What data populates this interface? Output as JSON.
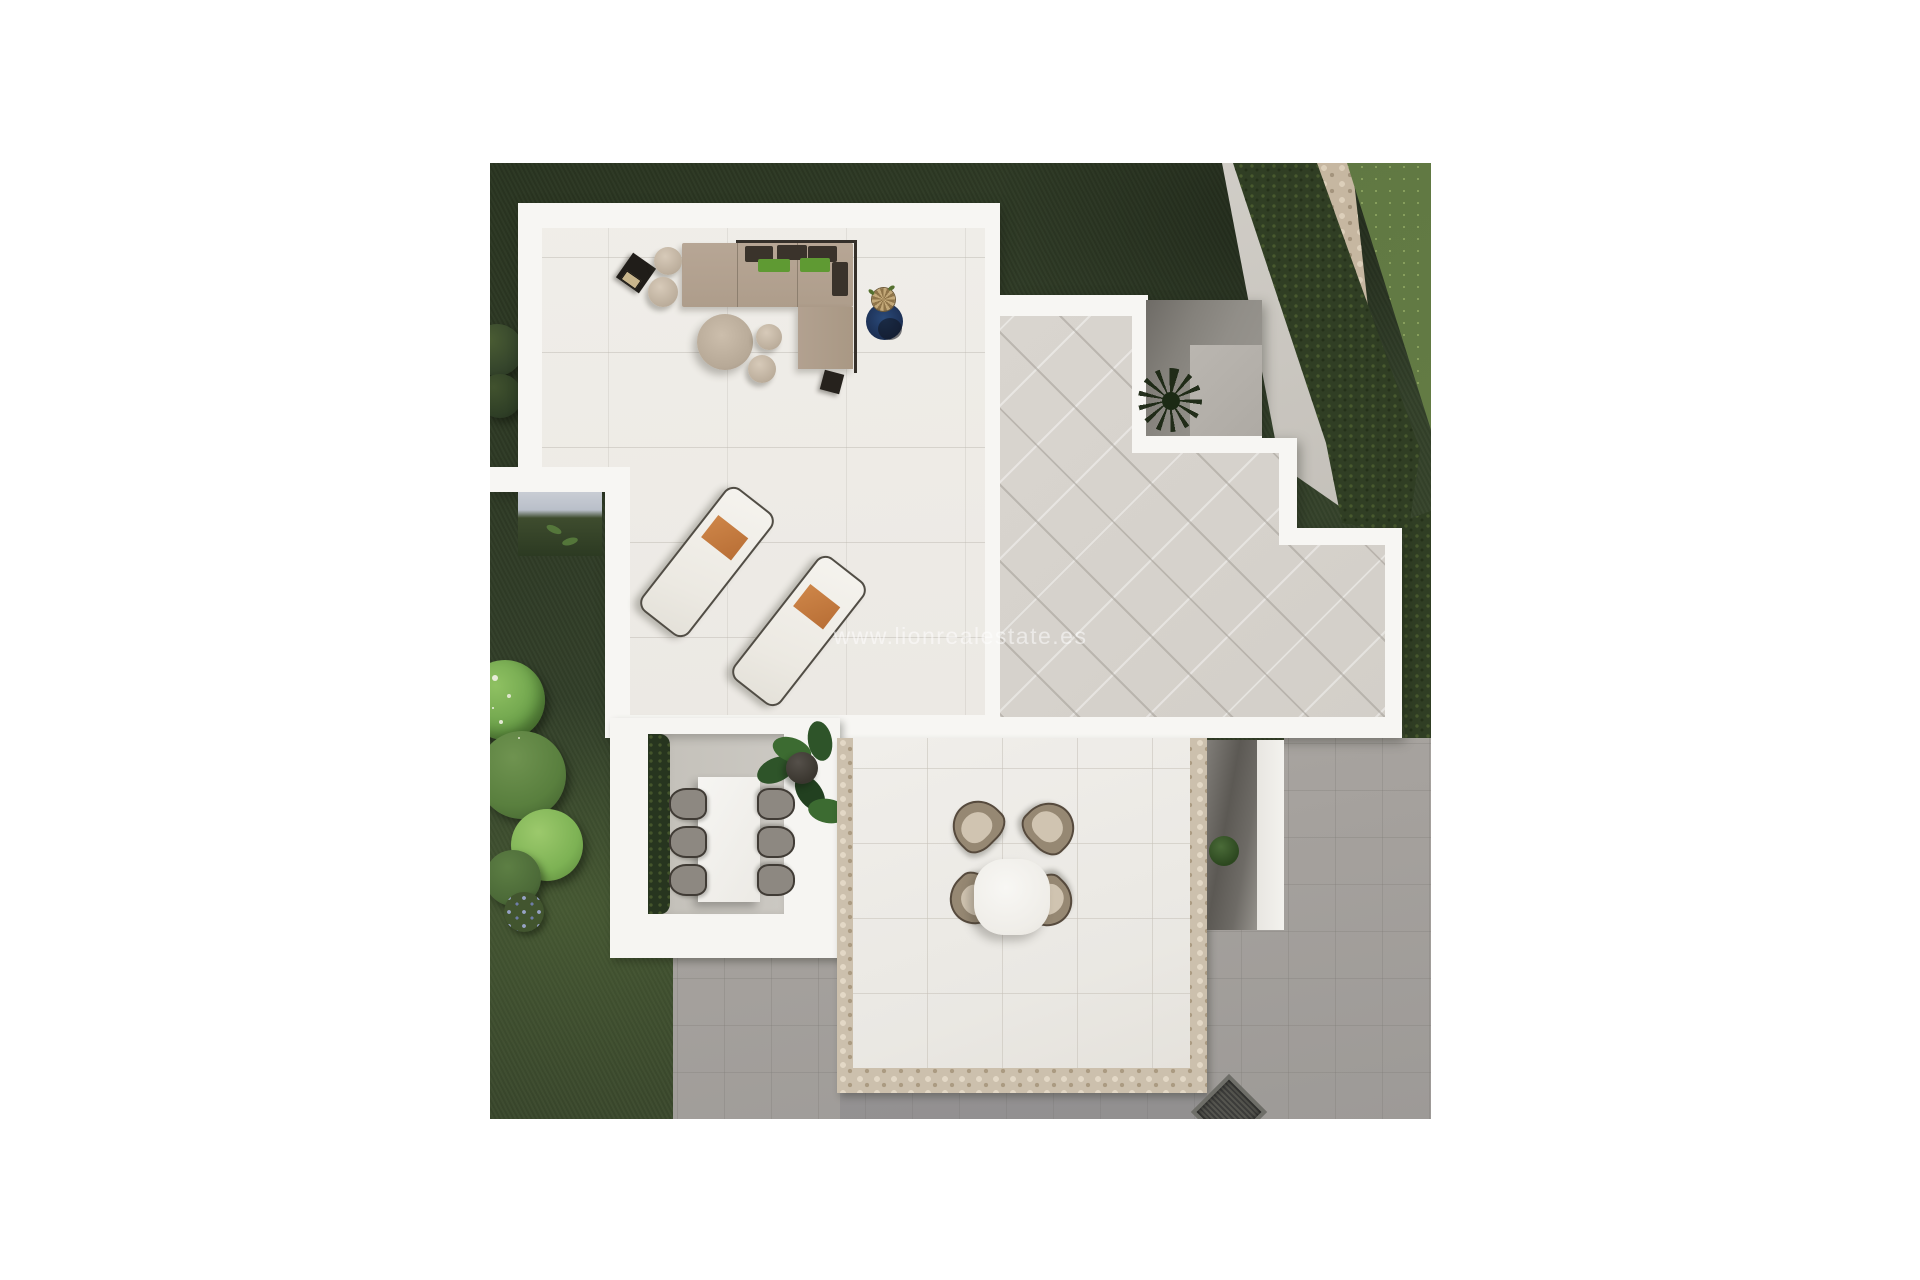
{
  "watermark": {
    "text": "www.lionrealestate.es"
  },
  "scene": {
    "type": "aerial-3d-render",
    "subject": "top-down 3D visualization of a modern villa with roof terraces and garden",
    "areas": [
      {
        "name": "living-roof-terrace",
        "items": [
          "l-shaped-sofa",
          "dark-back-cushions",
          "green-pillows",
          "round-coffee-table",
          "poufs",
          "black-side-tables",
          "potted-plant-on-blue-mat",
          "two-sun-loungers-with-orange-towels"
        ]
      },
      {
        "name": "tiled-roof-terrace",
        "items": [
          "diagonal-gray-tiles",
          "sunken-courtyard-with-palm"
        ]
      },
      {
        "name": "sunken-dining-patio",
        "items": [
          "rectangular-white-table",
          "six-gray-chairs",
          "hedge-strip",
          "large-leaf-plant"
        ]
      },
      {
        "name": "stone-trimmed-terrace",
        "items": [
          "round-white-table",
          "four-beige-shell-chairs"
        ]
      },
      {
        "name": "garden",
        "items": [
          "dark-lawn",
          "bright-lawn-corner",
          "diagonal-hedge",
          "stone-path",
          "flowering-bushes",
          "concrete-apron",
          "stairwell-recess",
          "grill-at-bottom-edge"
        ]
      }
    ],
    "colors": {
      "page_background": "#ffffff",
      "lawn_dark": "#33402a",
      "lawn_bright": "#647c45",
      "hedge": "#303e24",
      "stone_path": "#c6b7a1",
      "parapet_white": "#f7f6f3",
      "living_floor": "#ece9e4",
      "tiled_floor": "#d6d2cc",
      "concrete": "#aeaaa5",
      "sofa_taupe": "#b2a191",
      "cushion_dark": "#3a332b",
      "pillow_green": "#5f9a33",
      "towel_orange": "#c87a3e",
      "plant_mat_blue": "#1d3156",
      "watermark_text": "rgba(255,255,255,0.52)"
    },
    "counts": {
      "sun_loungers": 2,
      "dining_chairs": 6,
      "round_table_chairs": 4
    }
  }
}
